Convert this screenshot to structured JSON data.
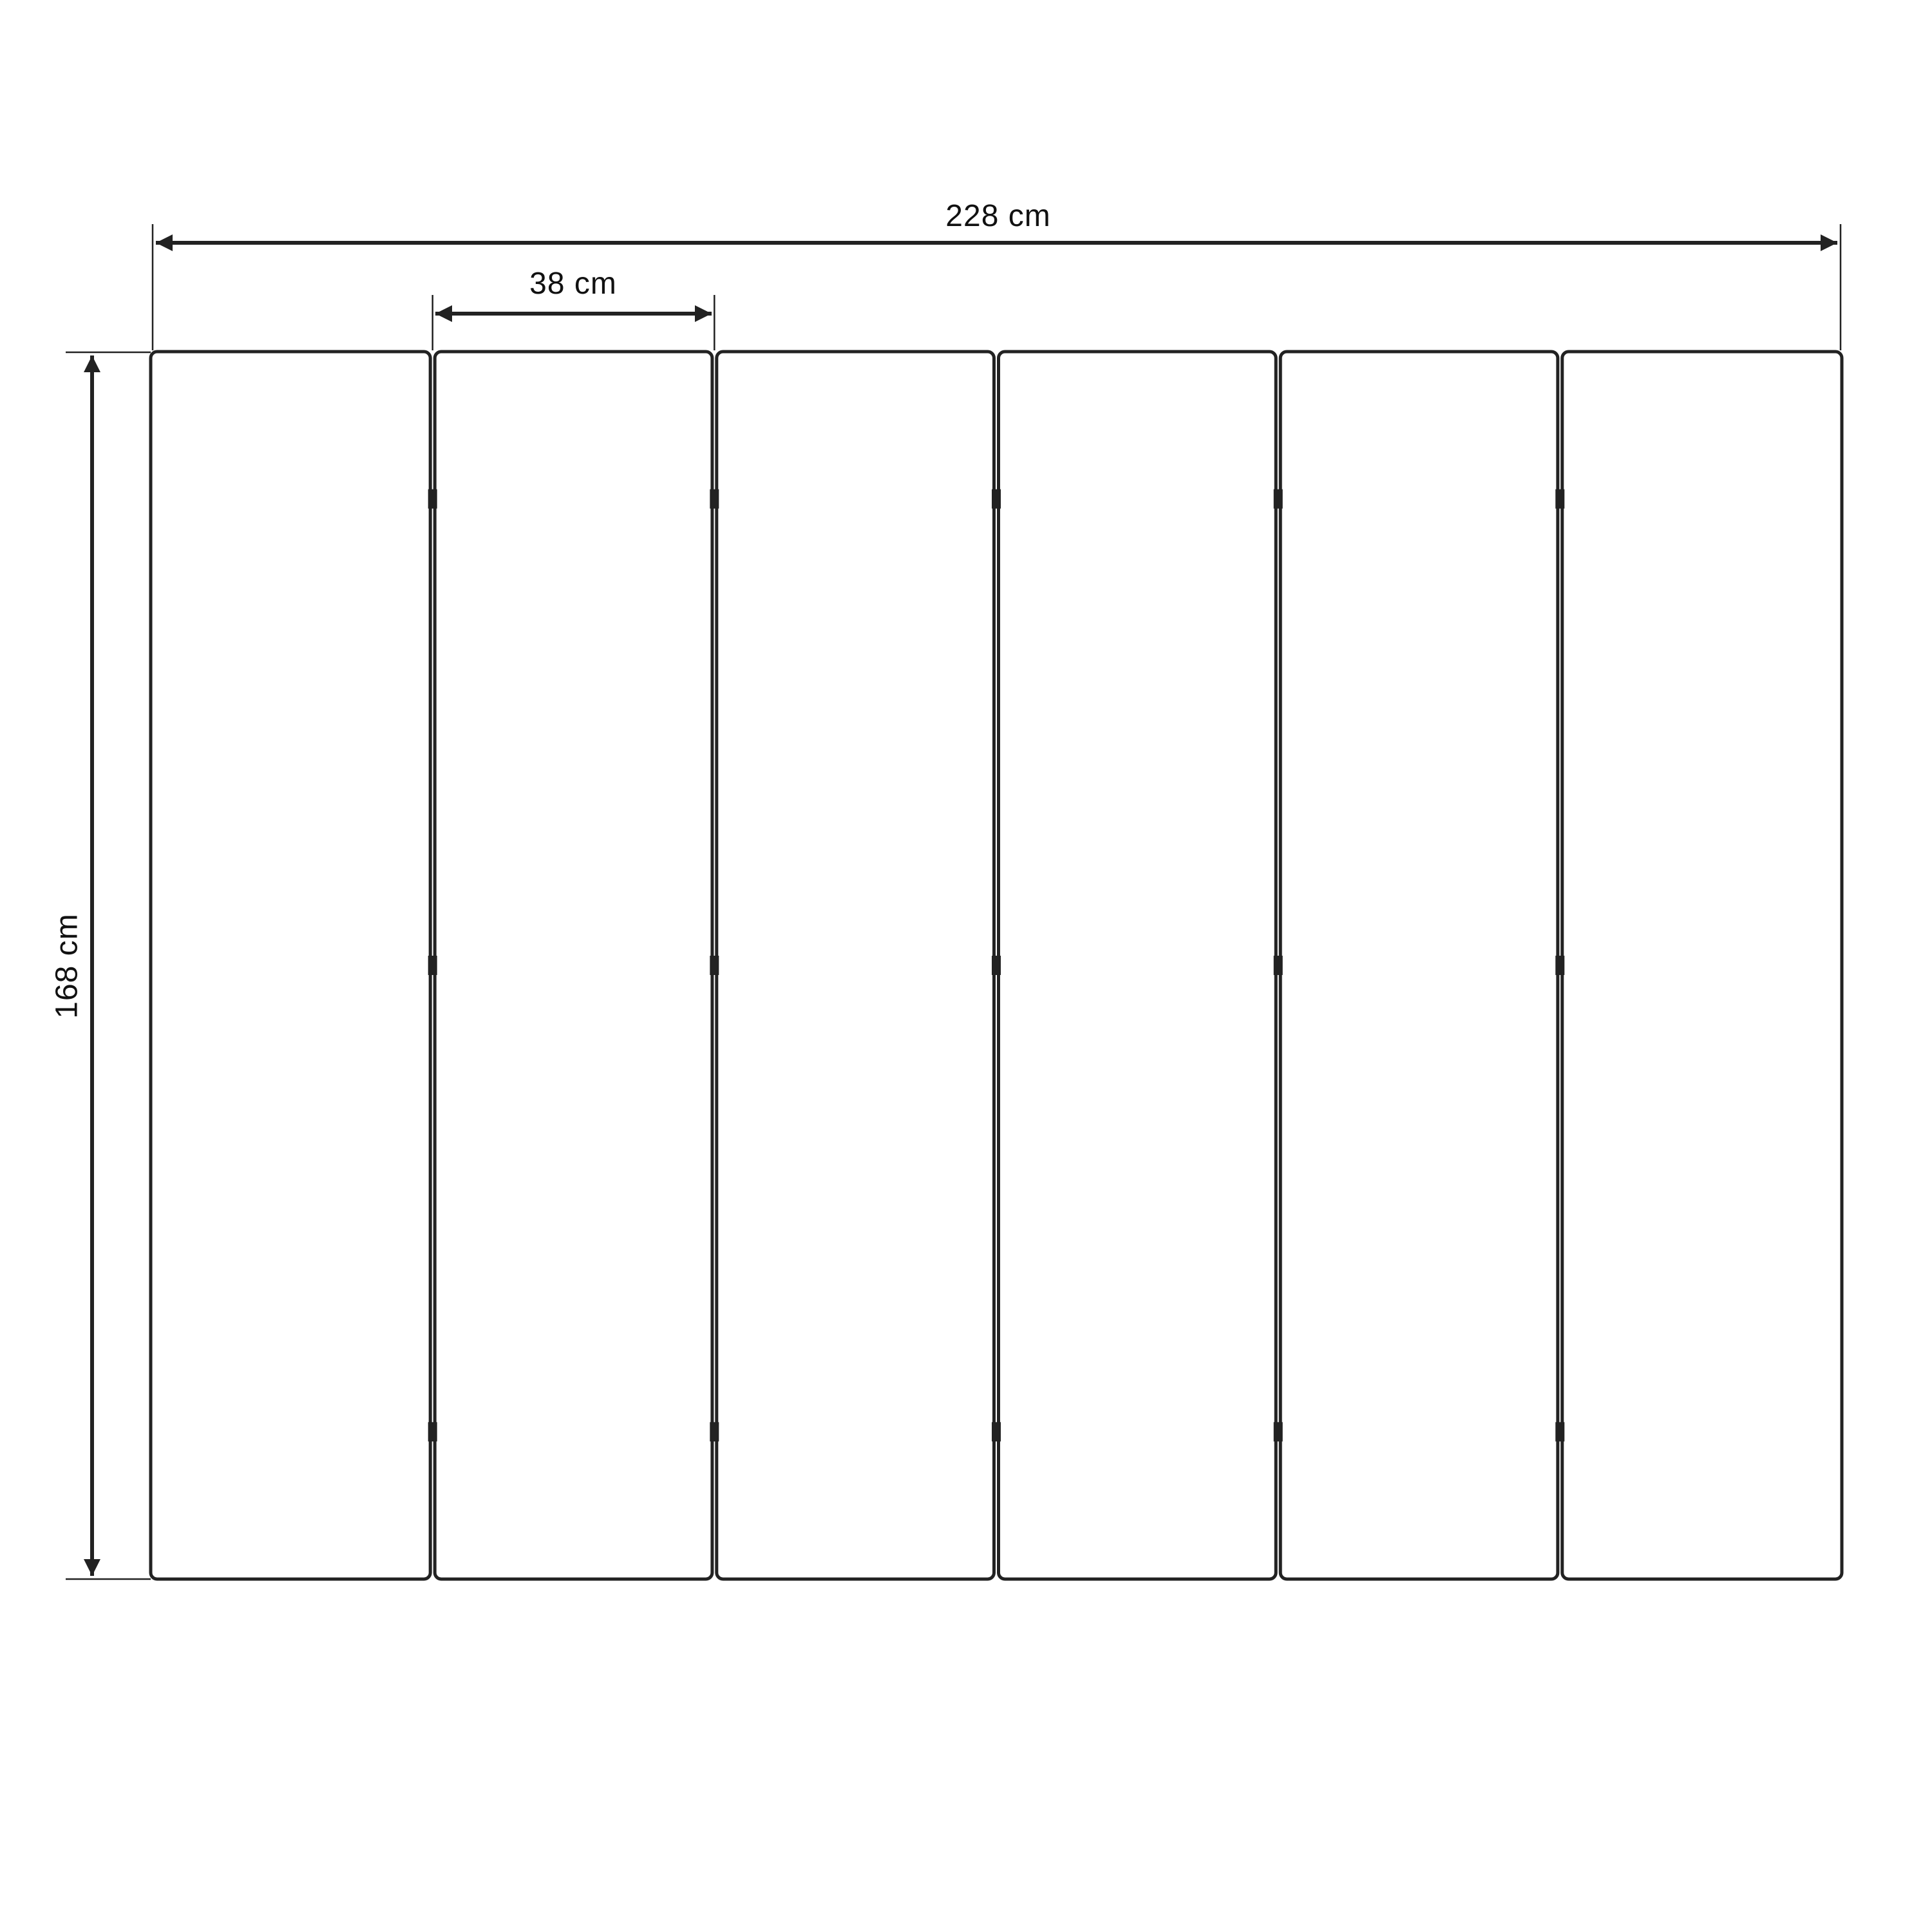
{
  "diagram": {
    "type": "dimensioned-technical-drawing",
    "subject": "six-panel folding screen front elevation",
    "panel_count": 6,
    "hinge_junction_count": 5,
    "hinges_per_junction": 3,
    "hinge_position_fractions": [
      0.12,
      0.5,
      0.88
    ],
    "dimensions": {
      "total_width": {
        "value": 228,
        "unit": "cm",
        "label": "228 cm"
      },
      "panel_width": {
        "value": 38,
        "unit": "cm",
        "label": "38 cm"
      },
      "height": {
        "value": 168,
        "unit": "cm",
        "label": "168 cm"
      }
    },
    "colors": {
      "line": "#222222",
      "text": "#111111",
      "background": "#ffffff"
    }
  }
}
